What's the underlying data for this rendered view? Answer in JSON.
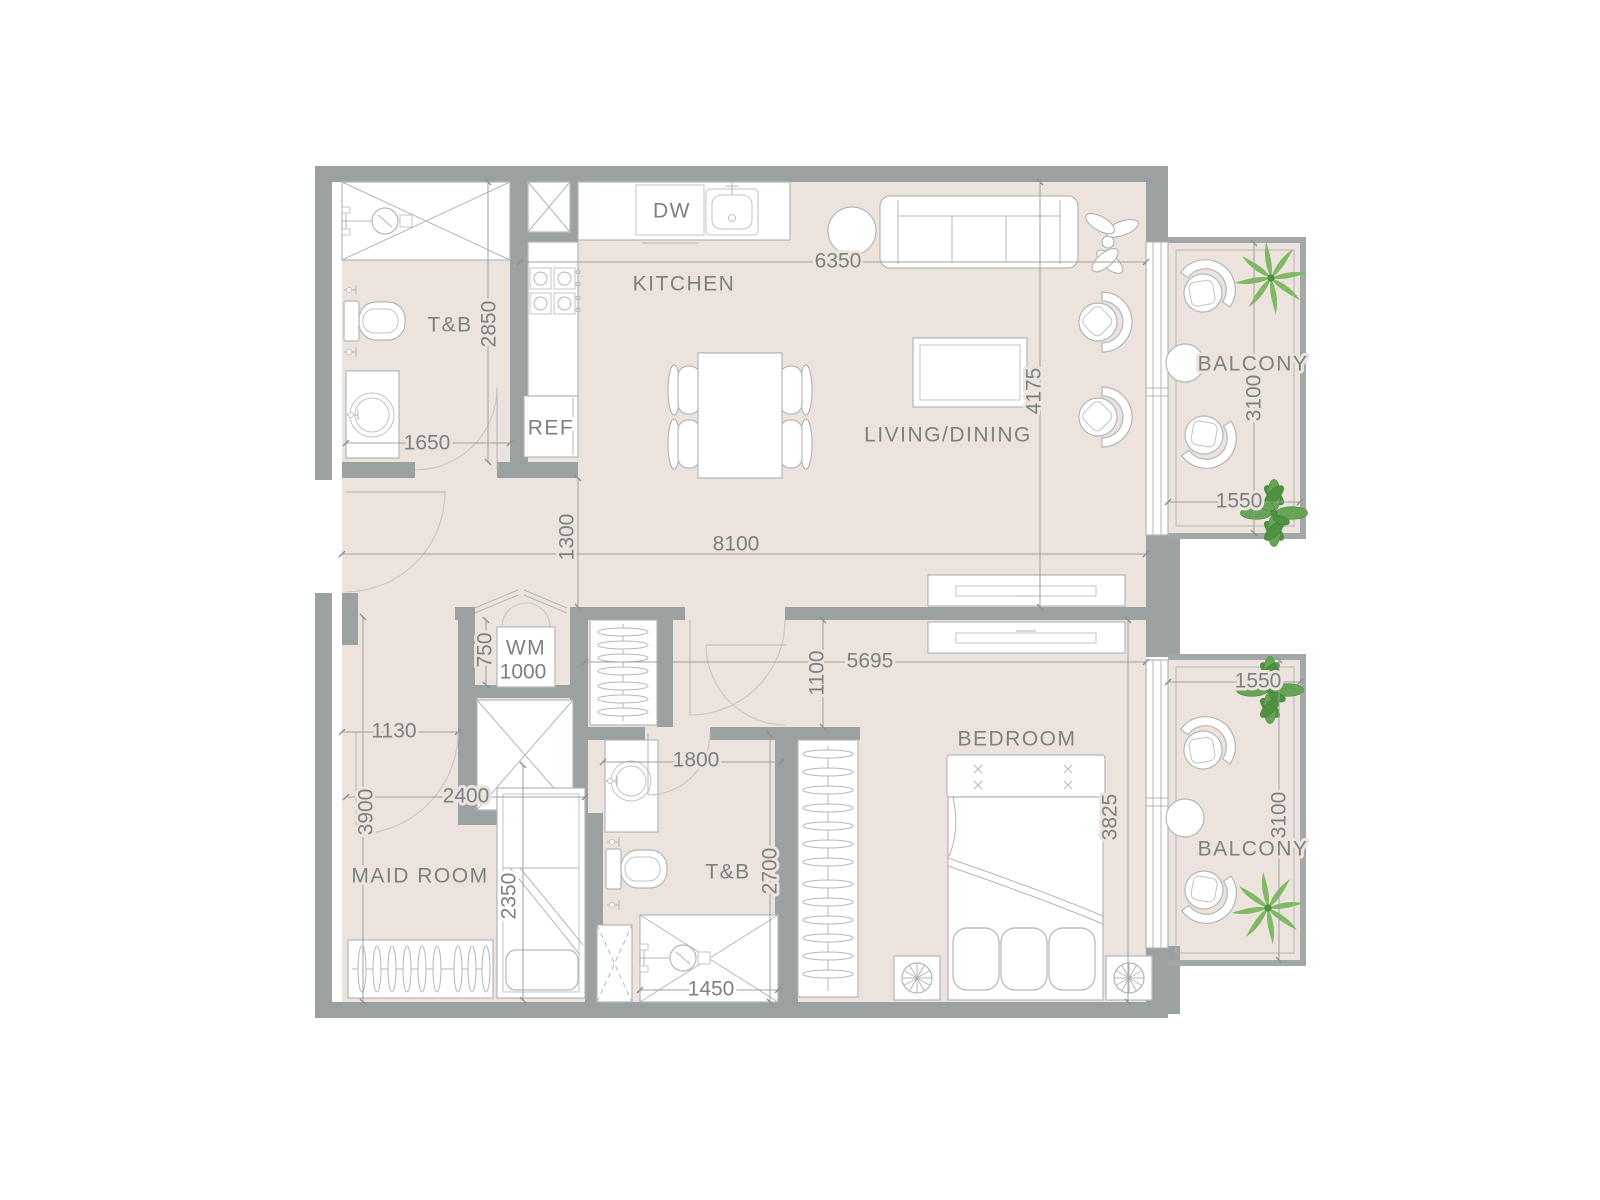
{
  "colors": {
    "wall": "#9aa1a0",
    "floor": "#ece3dd",
    "outline": "#b2b7b6",
    "text": "#7b8180",
    "plant_green": "#67a556",
    "palm_green": "#7fb966",
    "background": "#ffffff"
  },
  "rooms": {
    "tb_top": "T&B",
    "kitchen": "KITCHEN",
    "living": "LIVING/DINING",
    "balcony_top": "BALCONY",
    "maid": "MAID ROOM",
    "tb_mid": "T&B",
    "bedroom": "BEDROOM",
    "balcony_bottom": "BALCONY"
  },
  "appliances": {
    "dishwasher": "DW",
    "fridge": "REF",
    "washer": "WM"
  },
  "dims": {
    "d6350": "6350",
    "d2850": "2850",
    "d1650": "1650",
    "d4175": "4175",
    "d3100_top": "3100",
    "d1550_top": "1550",
    "d1300": "1300",
    "d8100": "8100",
    "d750": "750",
    "d1000": "1000",
    "d1130": "1130",
    "d5695": "5695",
    "d1100": "1100",
    "d2400": "2400",
    "d3900": "3900",
    "d2350": "2350",
    "d1800": "1800",
    "d2700": "2700",
    "d1450": "1450",
    "d3825": "3825",
    "d1550_bottom": "1550",
    "d3100_bottom": "3100"
  }
}
